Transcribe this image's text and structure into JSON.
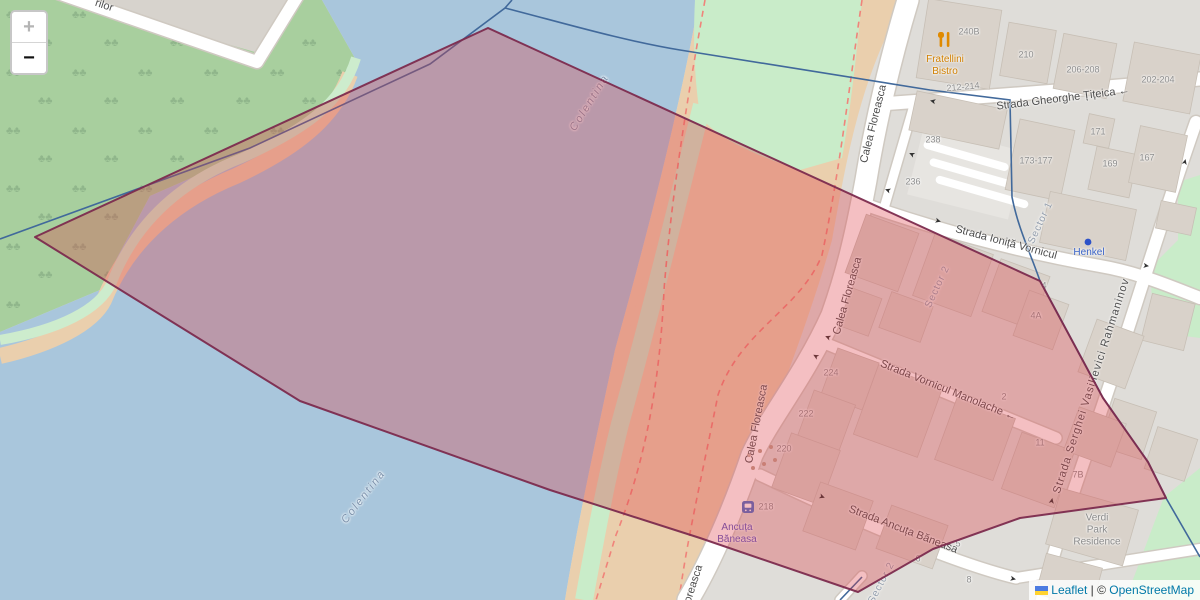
{
  "controls": {
    "zoom_in": "+",
    "zoom_out": "−"
  },
  "attribution": {
    "leaflet": "Leaflet",
    "separator": " | © ",
    "osm": "OpenStreetMap"
  },
  "colors": {
    "water": "#a9c6dc",
    "park": "#a8cf9e",
    "urban": "#dfddd9",
    "sand": "#eacfad",
    "grass": "#c9ecc9",
    "bld": "#d9d2ca",
    "road": "#ffffff",
    "poly": "#de3c46",
    "polys": "#7c2b4e",
    "dash": "#f0837a",
    "admin": "#41699b",
    "link": "#0078A8"
  },
  "map": {
    "labels": [
      {
        "name": "road-label-rilor",
        "text": "rilor",
        "x": 104,
        "y": 6,
        "rot": 18,
        "cls": "street"
      },
      {
        "name": "street-gheorghe-titeica",
        "text": "Strada Gheorghe Țițeica ←",
        "x": 1063,
        "y": 99,
        "rot": -7,
        "cls": "street"
      },
      {
        "name": "street-calea-floreasca-1",
        "text": "Calea Floreasca",
        "x": 874,
        "y": 124,
        "rot": -76,
        "cls": "street"
      },
      {
        "name": "street-calea-floreasca-2",
        "text": "Calea Floreasca",
        "x": 848,
        "y": 296,
        "rot": -74,
        "cls": "street"
      },
      {
        "name": "street-calea-floreasca-3",
        "text": "Calea Floreasca",
        "x": 757,
        "y": 424,
        "rot": -79,
        "cls": "street"
      },
      {
        "name": "street-calea-floreasca-4",
        "text": "oreasca",
        "x": 694,
        "y": 584,
        "rot": -72,
        "cls": "street"
      },
      {
        "name": "street-ionita-vornicul",
        "text": "Strada Ioniță Vornicul",
        "x": 1006,
        "y": 243,
        "rot": 15,
        "cls": "street"
      },
      {
        "name": "street-vornicul-manolache",
        "text": "Strada Vornicul Manolache ←",
        "x": 948,
        "y": 391,
        "rot": 22,
        "cls": "street"
      },
      {
        "name": "street-ancuta-baneasa",
        "text": "Strada Ancuța Băneasa",
        "x": 903,
        "y": 530,
        "rot": 21,
        "cls": "street"
      },
      {
        "name": "street-rahmaninov",
        "text": "Strada Serghei Vasilievici Rahmaninov",
        "x": 1092,
        "y": 386,
        "rot": -72,
        "cls": "street",
        "ls": 1
      },
      {
        "name": "housenumber-240b",
        "text": "240B",
        "x": 969,
        "y": 32,
        "rot": 0,
        "cls": "num"
      },
      {
        "name": "housenumber-210",
        "text": "210",
        "x": 1026,
        "y": 55,
        "rot": 0,
        "cls": "num"
      },
      {
        "name": "housenumber-206-208",
        "text": "206-208",
        "x": 1083,
        "y": 70,
        "rot": 0,
        "cls": "num"
      },
      {
        "name": "housenumber-202-204",
        "text": "202-204",
        "x": 1158,
        "y": 80,
        "rot": 0,
        "cls": "num"
      },
      {
        "name": "housenumber-212-214",
        "text": "212-214",
        "x": 963,
        "y": 87,
        "rot": -5,
        "cls": "num"
      },
      {
        "name": "housenumber-238",
        "text": "238",
        "x": 933,
        "y": 140,
        "rot": 0,
        "cls": "num"
      },
      {
        "name": "housenumber-236",
        "text": "236",
        "x": 913,
        "y": 182,
        "rot": 0,
        "cls": "num"
      },
      {
        "name": "housenumber-173-177",
        "text": "173-177",
        "x": 1036,
        "y": 161,
        "rot": 0,
        "cls": "num"
      },
      {
        "name": "housenumber-171",
        "text": "171",
        "x": 1098,
        "y": 132,
        "rot": 0,
        "cls": "num"
      },
      {
        "name": "housenumber-169",
        "text": "169",
        "x": 1110,
        "y": 164,
        "rot": 0,
        "cls": "num"
      },
      {
        "name": "housenumber-167",
        "text": "167",
        "x": 1147,
        "y": 158,
        "rot": 0,
        "cls": "num"
      },
      {
        "name": "housenumber-4",
        "text": "4",
        "x": 1044,
        "y": 286,
        "rot": 0,
        "cls": "num"
      },
      {
        "name": "housenumber-4a",
        "text": "4A",
        "x": 1036,
        "y": 316,
        "rot": 0,
        "cls": "num"
      },
      {
        "name": "housenumber-224",
        "text": "224",
        "x": 831,
        "y": 373,
        "rot": 0,
        "cls": "num"
      },
      {
        "name": "housenumber-222",
        "text": "222",
        "x": 806,
        "y": 414,
        "rot": 0,
        "cls": "num"
      },
      {
        "name": "housenumber-220",
        "text": "220",
        "x": 784,
        "y": 449,
        "rot": 0,
        "cls": "num"
      },
      {
        "name": "housenumber-218",
        "text": "218",
        "x": 766,
        "y": 507,
        "rot": 0,
        "cls": "num"
      },
      {
        "name": "housenumber-2",
        "text": "2",
        "x": 1004,
        "y": 397,
        "rot": 0,
        "cls": "num"
      },
      {
        "name": "housenumber-11",
        "text": "11",
        "x": 1040,
        "y": 443,
        "rot": 0,
        "cls": "num"
      },
      {
        "name": "housenumber-7b",
        "text": "7B",
        "x": 1078,
        "y": 475,
        "rot": 0,
        "cls": "num"
      },
      {
        "name": "housenumber-5",
        "text": "5",
        "x": 958,
        "y": 544,
        "rot": 0,
        "cls": "num"
      },
      {
        "name": "housenumber-6",
        "text": "6",
        "x": 918,
        "y": 559,
        "rot": 0,
        "cls": "num"
      },
      {
        "name": "housenumber-8",
        "text": "8",
        "x": 969,
        "y": 580,
        "rot": 0,
        "cls": "num"
      },
      {
        "name": "river-label-colentina-north",
        "text": "Colentina",
        "x": 590,
        "y": 103,
        "rot": -58,
        "cls": "water-label"
      },
      {
        "name": "river-label-colentina-south",
        "text": "Colentina",
        "x": 364,
        "y": 497,
        "rot": -52,
        "cls": "water-label"
      },
      {
        "name": "sector-1-label",
        "text": "Sector 1",
        "x": 1041,
        "y": 223,
        "rot": -65,
        "cls": "sector"
      },
      {
        "name": "sector-2-label",
        "text": "Sector 2",
        "x": 938,
        "y": 287,
        "rot": -65,
        "cls": "sector"
      },
      {
        "name": "sector-2-label-south",
        "text": "Sector 2",
        "x": 882,
        "y": 583,
        "rot": -62,
        "cls": "sector"
      },
      {
        "name": "poi-fratellini-bistro",
        "text": "Fratellini\nBistro",
        "x": 945,
        "y": 66,
        "rot": 0,
        "cls": "poi-food"
      },
      {
        "name": "poi-henkel",
        "text": "Henkel",
        "x": 1089,
        "y": 253,
        "rot": 0,
        "cls": "poi-brand"
      },
      {
        "name": "busstop-ancuta-baneasa",
        "text": "Ancuța\nBăneasa",
        "x": 737,
        "y": 534,
        "rot": 0,
        "cls": "bus-name"
      },
      {
        "name": "poi-verdi-park-residence",
        "text": "Verdi\nPark\nResidence",
        "x": 1097,
        "y": 530,
        "rot": 0,
        "cls": "area-label"
      },
      {
        "name": "oneway-arrow-1",
        "text": "➤",
        "x": 933,
        "y": 101,
        "rot": 193,
        "cls": "arrow"
      },
      {
        "name": "oneway-arrow-2",
        "text": "➤",
        "x": 912,
        "y": 154,
        "rot": 205,
        "cls": "arrow"
      },
      {
        "name": "oneway-arrow-3",
        "text": "➤",
        "x": 888,
        "y": 190,
        "rot": 200,
        "cls": "arrow"
      },
      {
        "name": "oneway-arrow-4",
        "text": "➤",
        "x": 1185,
        "y": 162,
        "rot": -75,
        "cls": "arrow"
      },
      {
        "name": "oneway-arrow-5",
        "text": "➤",
        "x": 938,
        "y": 221,
        "rot": 15,
        "cls": "arrow"
      },
      {
        "name": "oneway-arrow-6",
        "text": "➤",
        "x": 1146,
        "y": 266,
        "rot": 8,
        "cls": "arrow"
      },
      {
        "name": "oneway-arrow-7",
        "text": "➤",
        "x": 828,
        "y": 337,
        "rot": 202,
        "cls": "arrow"
      },
      {
        "name": "oneway-arrow-8",
        "text": "➤",
        "x": 816,
        "y": 356,
        "rot": 210,
        "cls": "arrow"
      },
      {
        "name": "oneway-arrow-9",
        "text": "➤",
        "x": 1052,
        "y": 501,
        "rot": -78,
        "cls": "arrow"
      },
      {
        "name": "oneway-arrow-10",
        "text": "➤",
        "x": 822,
        "y": 497,
        "rot": 21,
        "cls": "arrow"
      },
      {
        "name": "oneway-arrow-11",
        "text": "➤",
        "x": 1013,
        "y": 579,
        "rot": 12,
        "cls": "arrow"
      }
    ]
  }
}
